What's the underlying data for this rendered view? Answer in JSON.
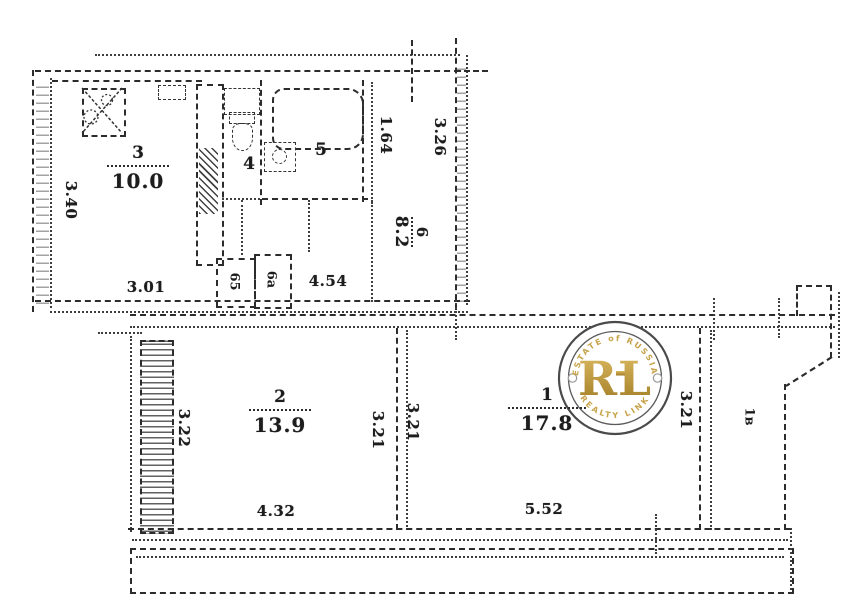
{
  "plan": {
    "rooms": {
      "living": {
        "number": "1",
        "area": "17.8"
      },
      "bedroom": {
        "number": "2",
        "area": "13.9"
      },
      "kitchen": {
        "number": "3",
        "area": "10.0"
      },
      "toilet": {
        "number": "4"
      },
      "bath": {
        "number": "5"
      },
      "hall": {
        "number": "6",
        "area": "8.2"
      },
      "closet_left": {
        "label": "65"
      },
      "closet_right": {
        "label": "6а"
      },
      "balcony": {
        "label": "1в"
      }
    },
    "dimensions": {
      "kitchen_left": "3.40",
      "kitchen_bottom": "3.01",
      "hall_top": "1.64",
      "right_wall": "3.26",
      "hall_bottom": "4.54",
      "bedroom_left": "3.22",
      "bedroom_bottom": "4.32",
      "bedroom_right": "3.21",
      "living_left": "3.21",
      "living_bottom": "5.52",
      "living_right": "3.21"
    }
  },
  "watermark": {
    "monogram": "RL",
    "arc_top": "ESTATE of RUSSIA",
    "arc_bottom": "REALTY LINK",
    "gold": "#b8912f",
    "ring": "#4a4a4a"
  }
}
